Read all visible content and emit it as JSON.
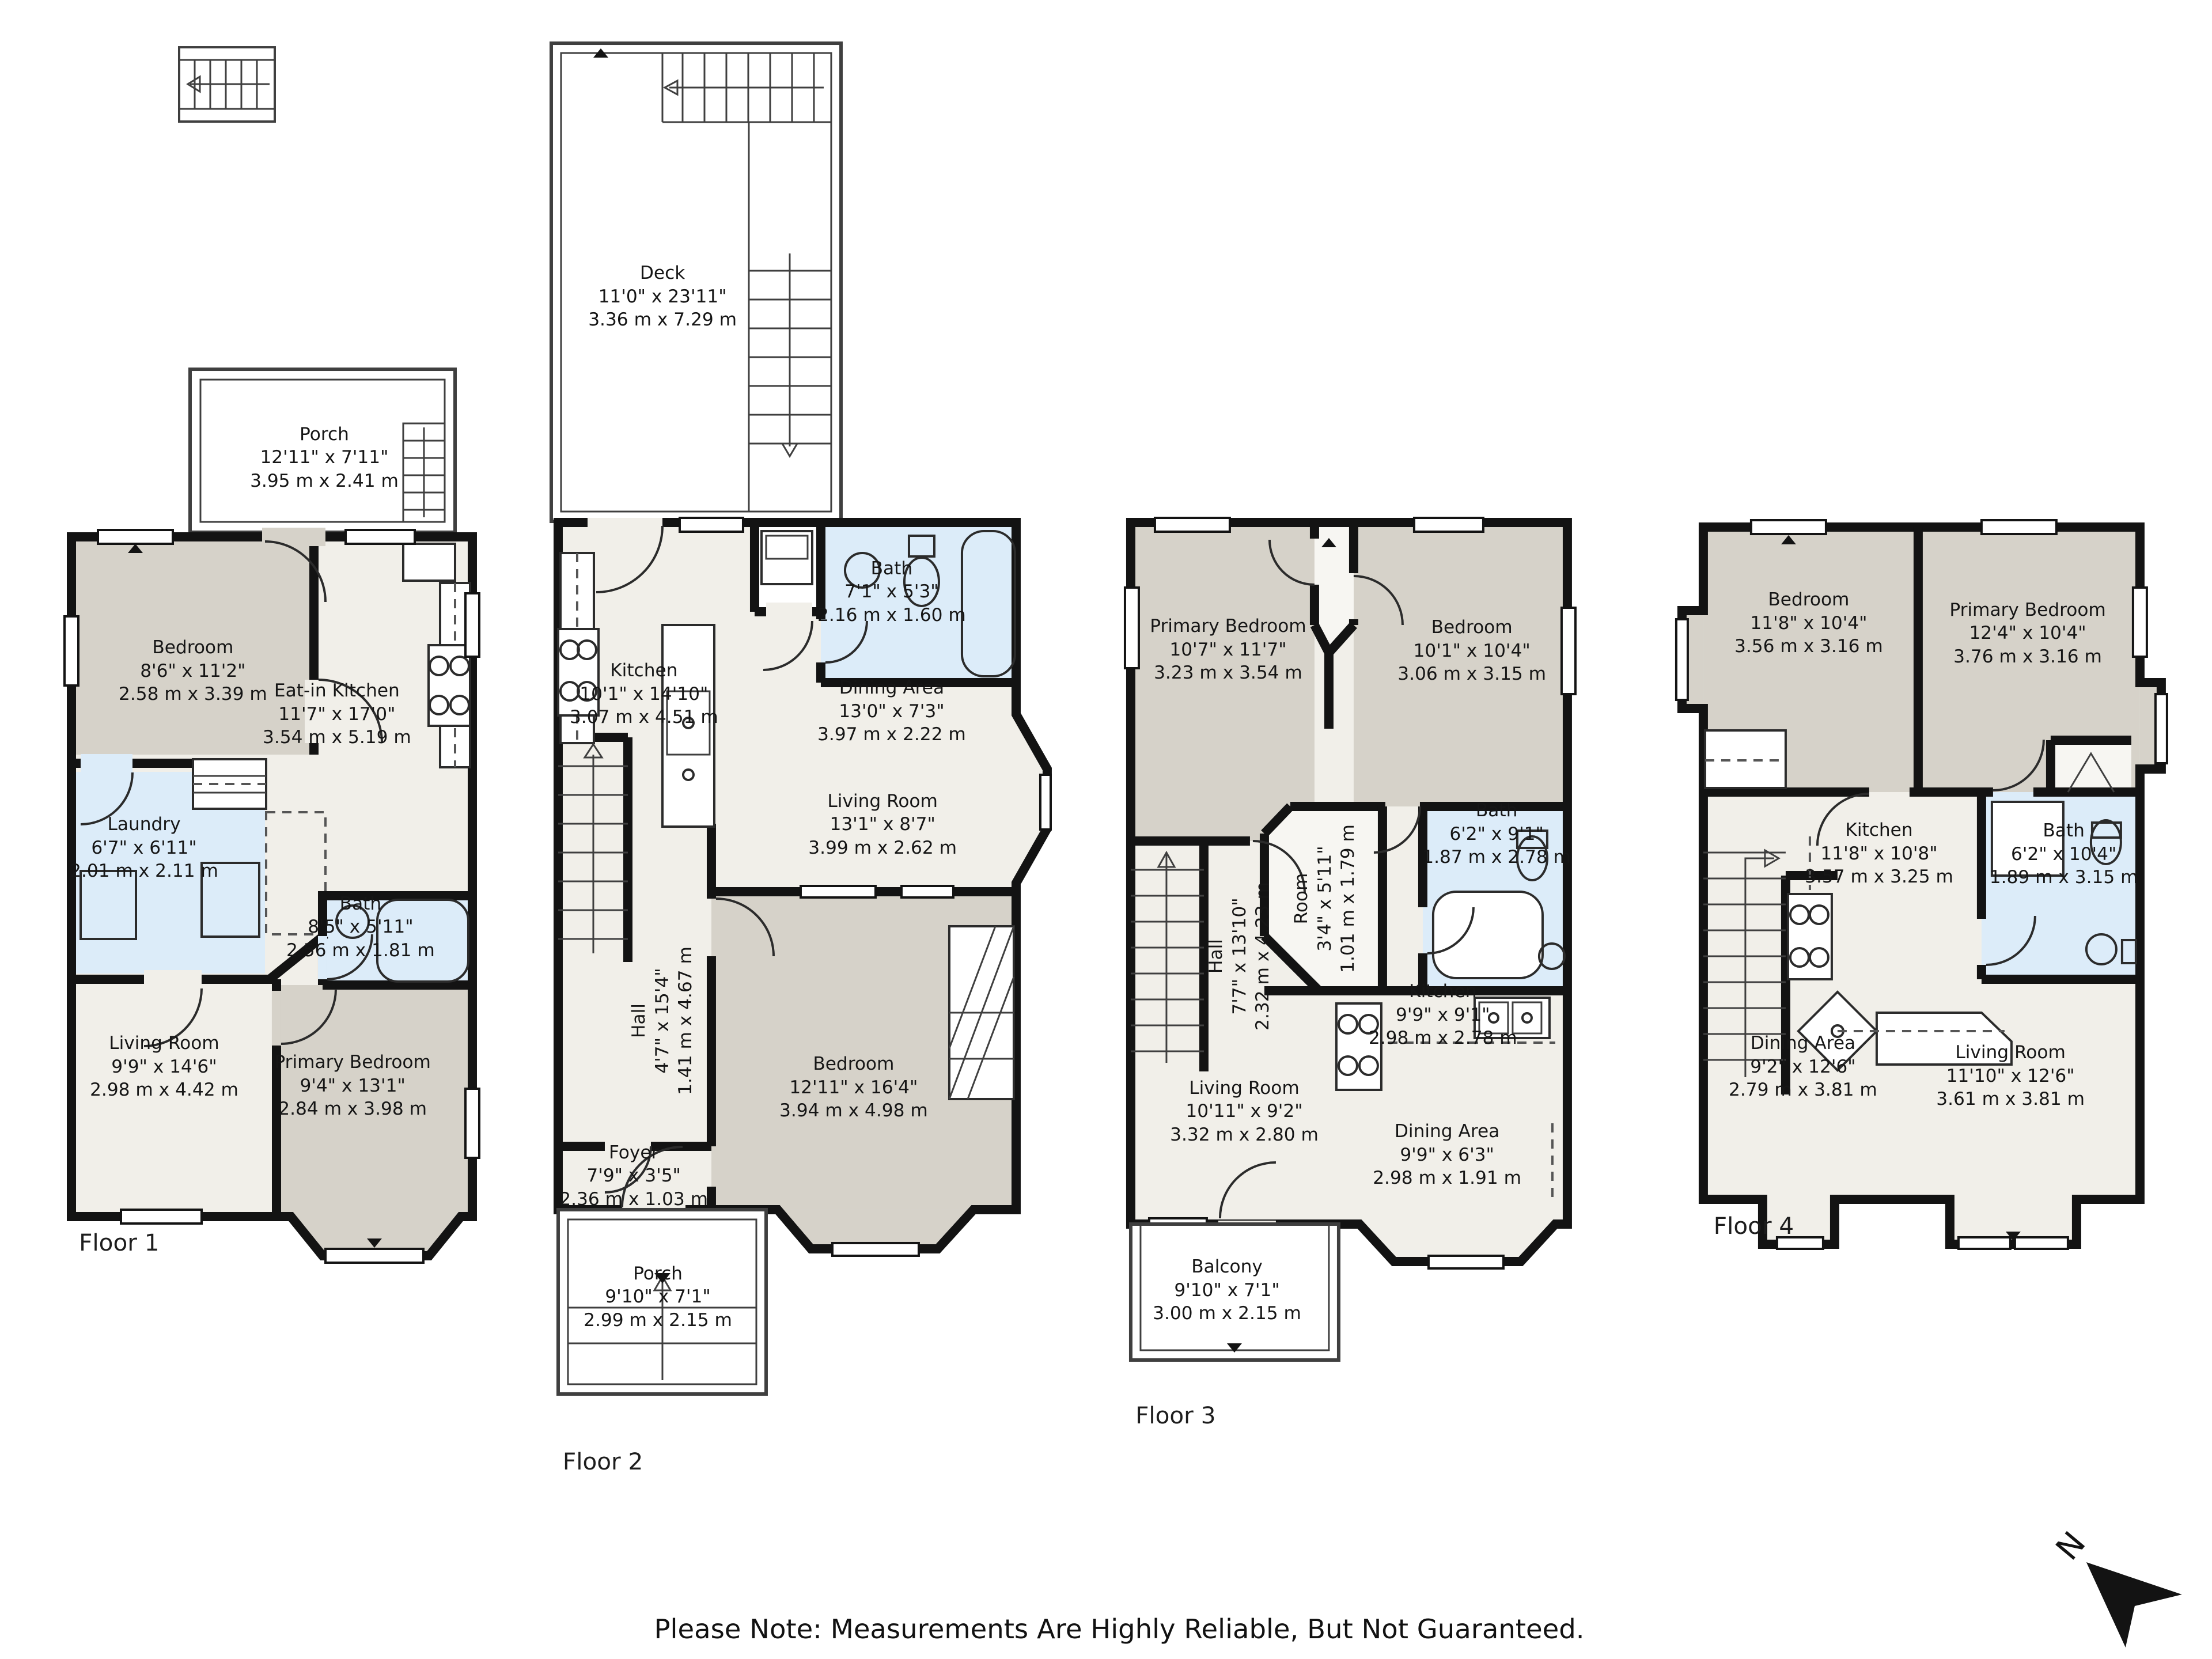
{
  "note": "Please Note: Measurements Are Highly Reliable, But Not Guaranteed.",
  "compass": {
    "label": "N"
  },
  "palette": {
    "wall": "#131313",
    "room": "#f1efe9",
    "bedroom": "#d6d2c9",
    "bath": "#dcecf9",
    "outline": "#3f3f3f"
  },
  "floors": [
    {
      "label": "Floor 1",
      "rooms": [
        {
          "name": "Porch",
          "imperial": "12'11\" x 7'11\"",
          "metric": "3.95 m x 2.41 m"
        },
        {
          "name": "Bedroom",
          "imperial": "8'6\" x 11'2\"",
          "metric": "2.58 m x 3.39 m"
        },
        {
          "name": "Eat-in Kitchen",
          "imperial": "11'7\" x 17'0\"",
          "metric": "3.54 m x 5.19 m"
        },
        {
          "name": "Laundry",
          "imperial": "6'7\" x 6'11\"",
          "metric": "2.01 m x 2.11 m"
        },
        {
          "name": "Bath",
          "imperial": "8'5\" x 5'11\"",
          "metric": "2.56 m x 1.81 m"
        },
        {
          "name": "Living Room",
          "imperial": "9'9\" x 14'6\"",
          "metric": "2.98 m x 4.42 m"
        },
        {
          "name": "Primary Bedroom",
          "imperial": "9'4\" x 13'1\"",
          "metric": "2.84 m x 3.98 m"
        }
      ]
    },
    {
      "label": "Floor 2",
      "rooms": [
        {
          "name": "Deck",
          "imperial": "11'0\" x 23'11\"",
          "metric": "3.36 m x 7.29 m"
        },
        {
          "name": "Kitchen",
          "imperial": "10'1\" x 14'10\"",
          "metric": "3.07 m x 4.51 m"
        },
        {
          "name": "Bath",
          "imperial": "7'1\" x 5'3\"",
          "metric": "2.16 m x 1.60 m"
        },
        {
          "name": "Dining Area",
          "imperial": "13'0\" x 7'3\"",
          "metric": "3.97 m x 2.22 m"
        },
        {
          "name": "Living Room",
          "imperial": "13'1\" x 8'7\"",
          "metric": "3.99 m x 2.62 m"
        },
        {
          "name": "Hall",
          "imperial": "4'7\" x 15'4\"",
          "metric": "1.41 m x 4.67 m"
        },
        {
          "name": "Bedroom",
          "imperial": "12'11\" x 16'4\"",
          "metric": "3.94 m x 4.98 m"
        },
        {
          "name": "Foyer",
          "imperial": "7'9\" x 3'5\"",
          "metric": "2.36 m x 1.03 m"
        },
        {
          "name": "Porch",
          "imperial": "9'10\" x 7'1\"",
          "metric": "2.99 m x 2.15 m"
        }
      ]
    },
    {
      "label": "Floor 3",
      "rooms": [
        {
          "name": "Primary Bedroom",
          "imperial": "10'7\" x 11'7\"",
          "metric": "3.23 m x 3.54 m"
        },
        {
          "name": "Bedroom",
          "imperial": "10'1\" x 10'4\"",
          "metric": "3.06 m x 3.15 m"
        },
        {
          "name": "Bath",
          "imperial": "6'2\" x 9'1\"",
          "metric": "1.87 m x 2.78 m"
        },
        {
          "name": "Hall",
          "imperial": "7'7\" x 13'10\"",
          "metric": "2.32 m x 4.23 m"
        },
        {
          "name": "Room",
          "imperial": "3'4\" x 5'11\"",
          "metric": "1.01 m x 1.79 m"
        },
        {
          "name": "Kitchen",
          "imperial": "9'9\" x 9'1\"",
          "metric": "2.98 m x 2.78 m"
        },
        {
          "name": "Living Room",
          "imperial": "10'11\" x 9'2\"",
          "metric": "3.32 m x 2.80 m"
        },
        {
          "name": "Dining Area",
          "imperial": "9'9\" x 6'3\"",
          "metric": "2.98 m x 1.91 m"
        },
        {
          "name": "Balcony",
          "imperial": "9'10\" x 7'1\"",
          "metric": "3.00 m x 2.15 m"
        }
      ]
    },
    {
      "label": "Floor 4",
      "rooms": [
        {
          "name": "Bedroom",
          "imperial": "11'8\" x 10'4\"",
          "metric": "3.56 m x 3.16 m"
        },
        {
          "name": "Primary Bedroom",
          "imperial": "12'4\" x 10'4\"",
          "metric": "3.76 m x 3.16 m"
        },
        {
          "name": "Kitchen",
          "imperial": "11'8\" x 10'8\"",
          "metric": "3.57 m x 3.25 m"
        },
        {
          "name": "Bath",
          "imperial": "6'2\" x 10'4\"",
          "metric": "1.89 m x 3.15 m"
        },
        {
          "name": "Dining Area",
          "imperial": "9'2\" x 12'6\"",
          "metric": "2.79 m x 3.81 m"
        },
        {
          "name": "Living Room",
          "imperial": "11'10\" x 12'6\"",
          "metric": "3.61 m x 3.81 m"
        }
      ]
    }
  ]
}
